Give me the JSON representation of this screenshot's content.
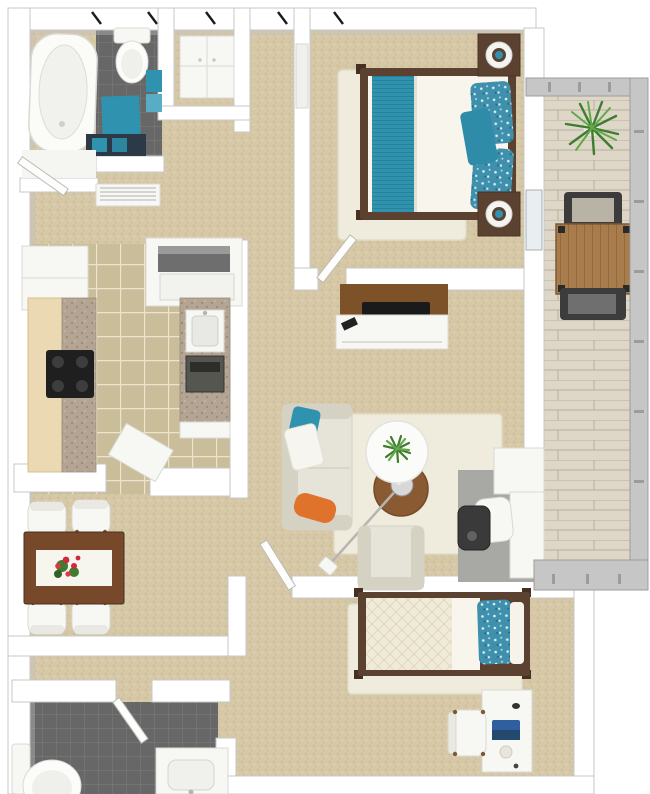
{
  "scene": {
    "type": "3d-apartment-floor-plan-rendering",
    "rooms": [
      {
        "name": "bathroom-1",
        "furniture": [
          "bathtub",
          "toilet",
          "vanity-sink",
          "teal-bath-mat",
          "teal-towels",
          "radiator",
          "entry-door"
        ]
      },
      {
        "name": "hall-closet",
        "furniture": [
          "white-dresser",
          "closed-door"
        ]
      },
      {
        "name": "master-bedroom",
        "furniture": [
          "double-bed",
          "teal-striped-runner",
          "teal-floral-pillows",
          "teal-accent-pillow",
          "nightstand-left",
          "nightstand-right",
          "sphere-lamp",
          "sphere-lamp",
          "white-area-rug",
          "tv-console",
          "flat-tv",
          "remote",
          "swing-door"
        ]
      },
      {
        "name": "balcony",
        "furniture": [
          "potted-palm",
          "slatted-wood-table",
          "patio-chair-top",
          "patio-chair-bottom",
          "railing-top",
          "railing-right",
          "railing-bottom"
        ]
      },
      {
        "name": "kitchen",
        "furniture": [
          "refrigerator",
          "stacked-washer-dryer",
          "left-counter-cabinets",
          "granite-countertop",
          "black-cooktop",
          "right-counter",
          "sink",
          "wall-oven",
          "corner-cabinet"
        ]
      },
      {
        "name": "dining-area",
        "furniture": [
          "wood-dining-table",
          "white-table-runner",
          "red-flower-centerpiece",
          "dining-chair",
          "dining-chair",
          "dining-chair",
          "dining-chair"
        ]
      },
      {
        "name": "living-room",
        "furniture": [
          "cream-sofa",
          "teal-throw-pillow",
          "white-throw-pillow",
          "orange-throw-pillow",
          "cream-area-rug",
          "round-white-coffee-table",
          "round-brown-side-table",
          "potted-plant",
          "arc-floor-lamp",
          "armchair",
          "desk-nook-desk",
          "desk-chair",
          "waste-bin",
          "gray-floor-mat",
          "swing-door"
        ]
      },
      {
        "name": "second-bedroom",
        "furniture": [
          "twin-bed",
          "quilted-mattress",
          "teal-floral-pillow",
          "white-area-rug",
          "white-desk",
          "laptop",
          "mouse",
          "cup",
          "desk-chair"
        ]
      },
      {
        "name": "second-bathroom",
        "furniture": [
          "toilet",
          "vanity-sink",
          "swing-door"
        ]
      }
    ]
  },
  "palette": {
    "wall": "#ffffff",
    "wallEdge": "#c7c7c7",
    "shadow": "#c2c2c2",
    "glass": "#e9eef0",
    "carpet": "#d6c8a6",
    "carpetDot1": "#c7b791",
    "carpetDot2": "#e3d7b8",
    "kitchenTile": "#cabd9a",
    "grout": "#ece4cc",
    "bathTile": "#676767",
    "bathTileLine": "#7a7a7a",
    "deck": "#ded7c7",
    "deckSeam": "#b7afa0",
    "rug": "#efebdd",
    "rugEdge": "#e1dcc9",
    "sofa": "#e6e3d8",
    "sofaDark": "#d5d2c4",
    "mattress": "#f7f5ec",
    "quilt": "#f0ebd8",
    "quiltLine": "#ddd6bc",
    "teal": "#2f93af",
    "tealDark": "#23758e",
    "tealFloral": "#3e90ad",
    "orange": "#e0732c",
    "bedFrame": "#5a4130",
    "post": "#463020",
    "woodTable": "#77492a",
    "tvBrown": "#7d5229",
    "balconyWood": "#a87c4c",
    "balconyWoodDark": "#8f6639",
    "furnWhite": "#f7f7f4",
    "furnEdge": "#d9d9d3",
    "metal": "#c6c6c6",
    "metalDark": "#9c9c9c",
    "dark": "#3c3c3c",
    "tv": "#1a1a1a",
    "applianceDark": "#565650",
    "machineGray": "#6e6e6e",
    "granite": "#b3a493",
    "graniteDot": "#968672",
    "cabinet": "#ead9b2",
    "cabinetEdge": "#d6c08d",
    "plantGreen": "#3f7d2e",
    "plantLight": "#63a84a",
    "flowerRed": "#cf2a3c",
    "laptopBlue": "#2f5f9e",
    "vanityDark": "#2c3947",
    "chrome": "#d8d8d8",
    "chromeEdge": "#8f8f8f"
  }
}
